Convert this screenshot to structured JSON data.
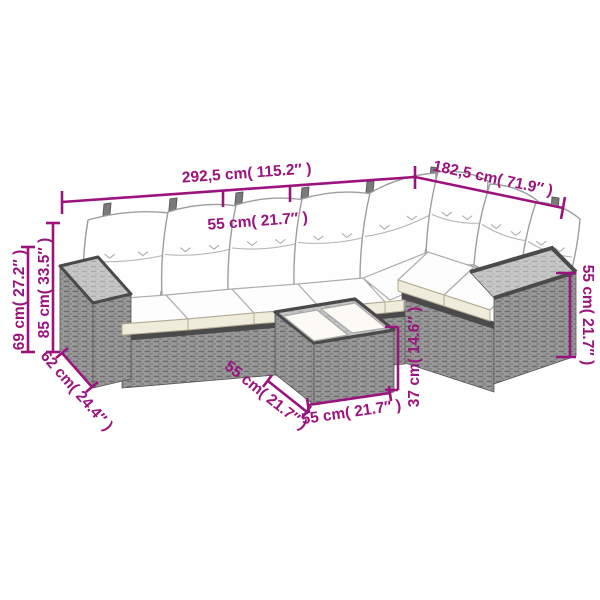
{
  "diagram": {
    "type": "product-dimension-diagram",
    "subject": "rattan-garden-lounge-set-with-coffee-table",
    "labels": {
      "sofa_total_width": "292,5 cm( 115.2″ )",
      "sofa_right_side_length": "182,5 cm( 71.9″ )",
      "seat_width": "55 cm( 21.7″ )",
      "back_height_with_cushion": "85 cm( 33.5″ )",
      "arm_frame_height": "69 cm( 27.2″ )",
      "sofa_depth": "62 cm( 24.4″ )",
      "right_arm_height": "55 cm( 21.7″ )",
      "table_height": "37 cm( 14.6″ )",
      "table_depth": "55 cm( 21.7″ )",
      "table_width": "55 cm( 21.7″ )"
    },
    "colors": {
      "dimension_accent": "#9B137D",
      "rattan_front": "#9a9a9a",
      "rattan_top": "#c8c8c8",
      "rattan_dark_edge": "#4a4a4a",
      "cushion_white": "#fdfdfd",
      "cushion_trim_cream": "#f0ecdc",
      "background": "#ffffff"
    }
  }
}
